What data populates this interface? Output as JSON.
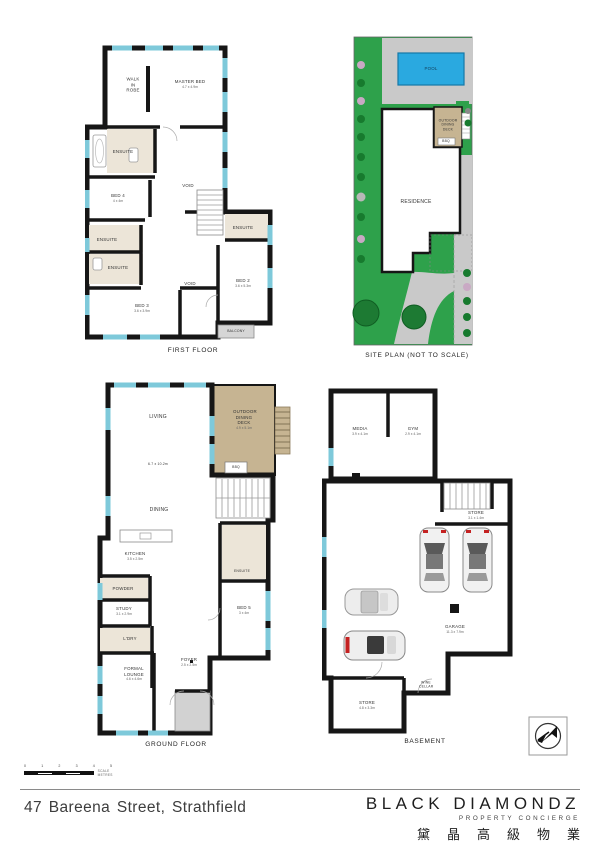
{
  "address": "47 Bareena Street, Strathfield",
  "brand": {
    "name": "BLACK DIAMONDZ",
    "tagline": "PROPERTY CONCIERGE",
    "cjk": "黛晶高級物業"
  },
  "scale_bar": {
    "ticks": [
      "0",
      "1",
      "2",
      "3",
      "4",
      "5"
    ],
    "label": "SCALE METRES"
  },
  "captions": {
    "first_floor": "FIRST FLOOR",
    "site_plan": "SITE PLAN (NOT TO SCALE)",
    "ground_floor": "GROUND FLOOR",
    "basement": "BASEMENT"
  },
  "first_floor": {
    "walk_in_robe": "WALK IN ROBE",
    "master_bed": "MASTER BED",
    "master_bed_dim": "4.7 x 4.9m",
    "ensuite": "ENSUITE",
    "void": "VOID",
    "bed4": "BED 4",
    "bed4_dim": "4 x 4m",
    "bed3": "BED 3",
    "bed3_dim": "3.6 x 3.9m",
    "bed2": "BED 2",
    "bed2_dim": "3.6 x 5.3m",
    "balcony": "BALCONY"
  },
  "site_plan": {
    "pool": "POOL",
    "residence": "RESIDENCE",
    "deck": "OUTDOOR DINING DECK",
    "bbq": "BBQ"
  },
  "ground_floor": {
    "living": "LIVING",
    "living_dim": "6.7 x 10.2m",
    "dining": "DINING",
    "deck": "OUTDOOR DINING DECK",
    "deck_dim": "4.9 x 5.1m",
    "bbq": "BBQ",
    "kitchen": "KITCHEN",
    "kitchen_dim": "3.5 x 2.5m",
    "powder": "POWDER",
    "study": "STUDY",
    "study_dim": "3.1 x 2.9m",
    "ldry": "L'DRY",
    "formal_lounge": "FORMAL LOUNGE",
    "formal_lounge_dim": "4.6 x 4.6m",
    "foyer": "FOYER",
    "foyer_dim": "2.5 x 2.5m",
    "bed5": "BED 5",
    "bed5_dim": "3 x 4m",
    "ensuite": "ENSUITE"
  },
  "basement": {
    "media": "MEDIA",
    "media_dim": "3.9 x 4.1m",
    "gym": "GYM",
    "gym_dim": "2.9 x 4.1m",
    "store1": "STORE",
    "store1_dim": "3.1 x 1.4m",
    "garage": "GARAGE",
    "garage_dim": "11.3 x 7.9m",
    "store2": "STORE",
    "store2_dim": "4.8 x 3.3m",
    "wine_cellar": "WINE CELLAR"
  },
  "colors": {
    "wall": "#161616",
    "window": "#7ec9da",
    "ensuite_floor": "#ece5d8",
    "deck": "#c6b492",
    "grass": "#2ea14b",
    "pool": "#2aa9e0",
    "paving": "#c9c9c9",
    "tree": "#1d7a33",
    "balcony": "#d6d6d6"
  }
}
